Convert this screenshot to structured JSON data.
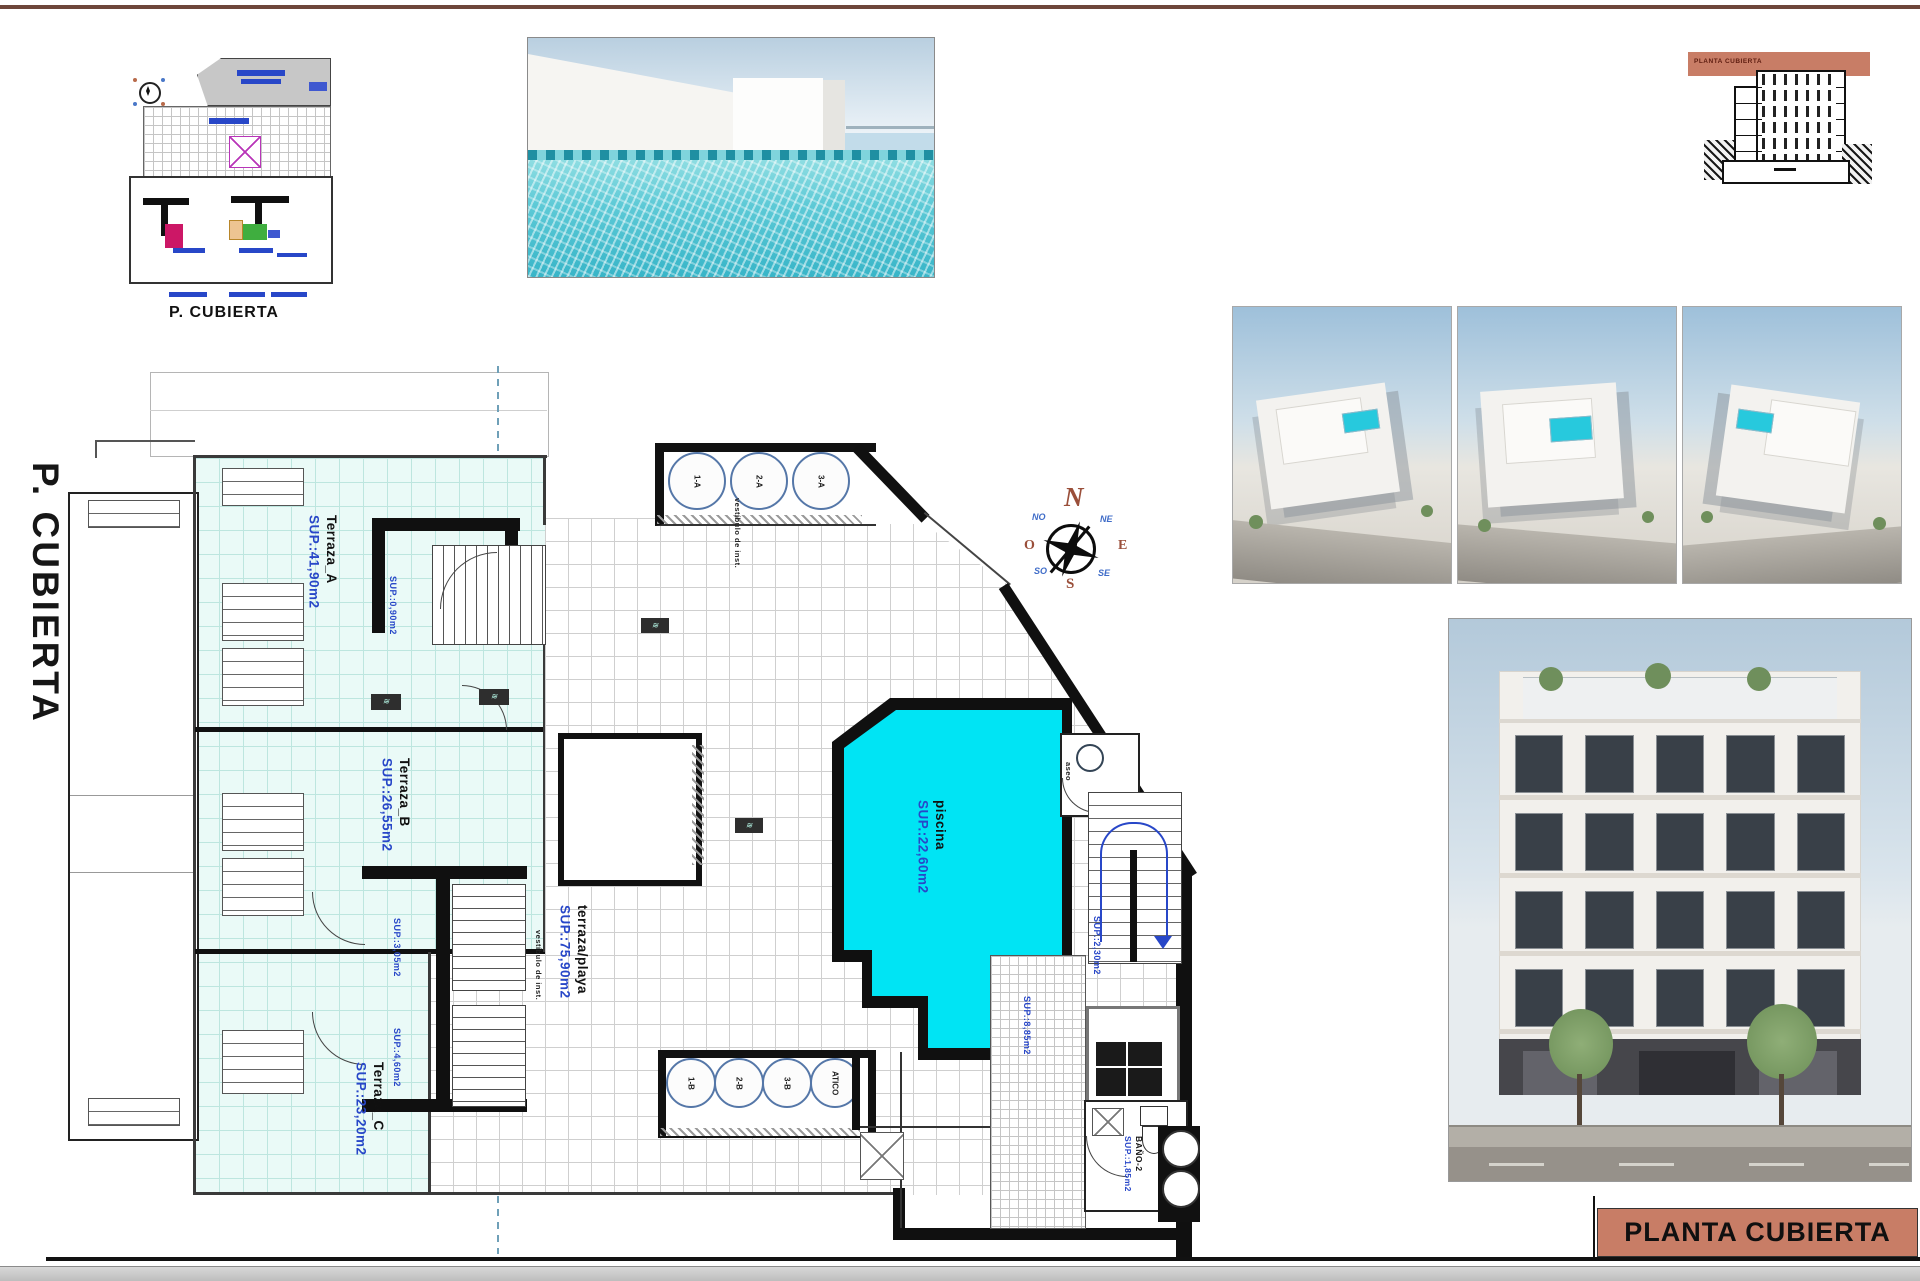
{
  "sheet": {
    "title_block": "PLANTA CUBIERTA",
    "side_label": "P. CUBIERTA",
    "key_plan_caption": "P. CUBIERTA",
    "section_band_label": "PLANTA CUBIERTA"
  },
  "compass": {
    "n": "N",
    "e": "E",
    "s": "S",
    "o": "O",
    "ne": "NE",
    "no": "NO",
    "se": "SE",
    "so": "SO"
  },
  "plan": {
    "rooms": {
      "terraza_a": {
        "name": "Terraza_A",
        "sup": "SUP.:41,90m2"
      },
      "terraza_b": {
        "name": "Terraza_B",
        "sup": "SUP.:26,55m2"
      },
      "terraza_c": {
        "name": "Terraza_C",
        "sup": "SUP.:23,20m2"
      },
      "piscina": {
        "name": "piscina",
        "sup": "SUP.:22,60m2"
      },
      "terraza_playa": {
        "name": "terraza/playa",
        "sup": "SUP.:75,90m2"
      },
      "bano2": {
        "name": "BAÑO-2",
        "sup": "SUP.:1,85m2"
      },
      "aseo": {
        "name": "aseo"
      }
    },
    "skylights_top": [
      "1-A",
      "2-A",
      "3-A"
    ],
    "skylights_bottom": [
      "1-B",
      "2-B",
      "3-B",
      "ATICO"
    ],
    "sup_labels": {
      "stair_a": "SUP.:0,90m2",
      "stair_b1": "SUP.:3,05m2",
      "stair_b2": "SUP.:4,60m2",
      "hall": "SUP.:2,30m2",
      "inst": "SUP.:8,85m2"
    },
    "vestibulo_top": "vestíbulo de inst.",
    "vestibulo_left": "vestíbulo de inst."
  },
  "colors": {
    "pool_cyan": "#00e4f4",
    "terrace_tile": "#eafaf7",
    "salmon_accent": "#c87d66",
    "label_blue": "#2847c8",
    "compass_brown": "#9a4f3a",
    "top_rule_brown": "#6e463a"
  }
}
